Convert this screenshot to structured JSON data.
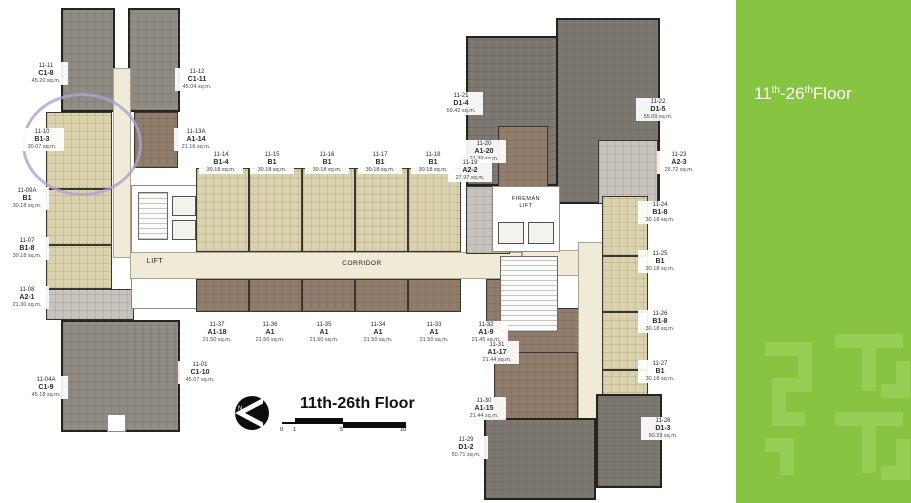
{
  "floorplan": {
    "title": "11th-26th Floor",
    "corridor_label": "CORRIDOR",
    "lift_label": "LIFT",
    "fireman_lift_line1": "FIREMAN",
    "fireman_lift_line2": "LIFT",
    "north_label": "N",
    "scale_ticks": [
      "0",
      "1",
      "5",
      "10"
    ],
    "units": [
      {
        "no": "11-11",
        "type": "C1-8",
        "area": "45.20 sq.m.",
        "lx": 24,
        "ly": 62
      },
      {
        "no": "11-12",
        "type": "C1-11",
        "area": "45.04 sq.m.",
        "lx": 175,
        "ly": 68
      },
      {
        "no": "11-10",
        "type": "B1-3",
        "area": "30.07 sq.m.",
        "lx": 20,
        "ly": 128
      },
      {
        "no": "11-13A",
        "type": "A1-14",
        "area": "21.16 sq.m.",
        "lx": 174,
        "ly": 128
      },
      {
        "no": "11-09A",
        "type": "B1",
        "area": "30.18 sq.m.",
        "lx": 5,
        "ly": 187
      },
      {
        "no": "11-07",
        "type": "B1-8",
        "area": "30.18 sq.m.",
        "lx": 5,
        "ly": 237
      },
      {
        "no": "11-08",
        "type": "A2-1",
        "area": "21.30 sq.m.",
        "lx": 5,
        "ly": 286
      },
      {
        "no": "11-04A",
        "type": "C1-9",
        "area": "45.18 sq.m.",
        "lx": 24,
        "ly": 376
      },
      {
        "no": "11-01",
        "type": "C1-10",
        "area": "45.07 sq.m.",
        "lx": 178,
        "ly": 361
      },
      {
        "no": "11-14",
        "type": "B1-4",
        "area": "30.18 sq.m.",
        "lx": 199,
        "ly": 151
      },
      {
        "no": "11-15",
        "type": "B1",
        "area": "30.18 sq.m.",
        "lx": 250,
        "ly": 151
      },
      {
        "no": "11-16",
        "type": "B1",
        "area": "30.18 sq.m.",
        "lx": 305,
        "ly": 151
      },
      {
        "no": "11-17",
        "type": "B1",
        "area": "30.18 sq.m.",
        "lx": 358,
        "ly": 151
      },
      {
        "no": "11-18",
        "type": "B1",
        "area": "30.18 sq.m.",
        "lx": 411,
        "ly": 151
      },
      {
        "no": "11-37",
        "type": "A1-18",
        "area": "21.50 sq.m.",
        "lx": 195,
        "ly": 321
      },
      {
        "no": "11-36",
        "type": "A1",
        "area": "21.50 sq.m.",
        "lx": 248,
        "ly": 321
      },
      {
        "no": "11-35",
        "type": "A1",
        "area": "21.50 sq.m.",
        "lx": 302,
        "ly": 321
      },
      {
        "no": "11-34",
        "type": "A1",
        "area": "21.50 sq.m.",
        "lx": 356,
        "ly": 321
      },
      {
        "no": "11-33",
        "type": "A1",
        "area": "21.50 sq.m.",
        "lx": 412,
        "ly": 321
      },
      {
        "no": "11-32",
        "type": "A1-9",
        "area": "21.45 sq.m.",
        "lx": 464,
        "ly": 321
      },
      {
        "no": "11-31",
        "type": "A1-17",
        "area": "21.44 sq.m.",
        "lx": 475,
        "ly": 341
      },
      {
        "no": "11-30",
        "type": "A1-15",
        "area": "21.44 sq.m.",
        "lx": 462,
        "ly": 397
      },
      {
        "no": "11-21",
        "type": "D1-4",
        "area": "59.42 sq.m.",
        "lx": 439,
        "ly": 92
      },
      {
        "no": "11-22",
        "type": "D1-5",
        "area": "55.09 sq.m.",
        "lx": 636,
        "ly": 98
      },
      {
        "no": "11-20",
        "type": "A1-20",
        "area": "21.39 sq.m.",
        "lx": 462,
        "ly": 140
      },
      {
        "no": "11-19",
        "type": "A2-2",
        "area": "27.97 sq.m.",
        "lx": 448,
        "ly": 159
      },
      {
        "no": "11-23",
        "type": "A2-3",
        "area": "26.72 sq.m.",
        "lx": 657,
        "ly": 151
      },
      {
        "no": "11-24",
        "type": "B1-8",
        "area": "30.18 sq.m.",
        "lx": 638,
        "ly": 201
      },
      {
        "no": "11-25",
        "type": "B1",
        "area": "30.18 sq.m.",
        "lx": 638,
        "ly": 250
      },
      {
        "no": "11-26",
        "type": "B1-8",
        "area": "30.18 sq.m.",
        "lx": 638,
        "ly": 310
      },
      {
        "no": "11-27",
        "type": "B1",
        "area": "30.18 sq.m.",
        "lx": 638,
        "ly": 360
      },
      {
        "no": "11-29",
        "type": "D1-2",
        "area": "50.71 sq.m.",
        "lx": 444,
        "ly": 436
      },
      {
        "no": "11-28",
        "type": "D1-3",
        "area": "50.29 sq.m.",
        "lx": 641,
        "ly": 417
      }
    ],
    "blocks": [
      {
        "name": "tower-c1-8",
        "x": 61,
        "y": 8,
        "w": 54,
        "h": 104,
        "cat": "gray"
      },
      {
        "name": "tower-c1-11",
        "x": 128,
        "y": 8,
        "w": 52,
        "h": 104,
        "cat": "gray"
      },
      {
        "name": "unit-block-b1-3",
        "x": 46,
        "y": 112,
        "w": 66,
        "h": 77,
        "cat": "beige"
      },
      {
        "name": "unit-block-a1-14",
        "x": 134,
        "y": 112,
        "w": 44,
        "h": 56,
        "cat": "brown"
      },
      {
        "name": "unit-block-b1-09a",
        "x": 46,
        "y": 189,
        "w": 66,
        "h": 56,
        "cat": "beige"
      },
      {
        "name": "unit-block-b1-8-07",
        "x": 46,
        "y": 245,
        "w": 66,
        "h": 44,
        "cat": "beige"
      },
      {
        "name": "unit-block-a2-1",
        "x": 46,
        "y": 289,
        "w": 88,
        "h": 31,
        "cat": "a2"
      },
      {
        "name": "tower-c1-9-c1-10",
        "x": 61,
        "y": 320,
        "w": 119,
        "h": 112,
        "cat": "gray"
      },
      {
        "name": "notch-bottom-left",
        "x": 107,
        "y": 414,
        "w": 19,
        "h": 18,
        "cat": "white"
      },
      {
        "name": "corridor-vertical-left",
        "x": 113,
        "y": 68,
        "w": 18,
        "h": 190,
        "cat": "cream"
      },
      {
        "name": "core-left",
        "x": 131,
        "y": 185,
        "w": 71,
        "h": 124,
        "cat": "white"
      },
      {
        "name": "stair-left",
        "x": 138,
        "y": 192,
        "w": 30,
        "h": 48,
        "cat": "stair"
      },
      {
        "name": "lift-shaft-left-1",
        "x": 172,
        "y": 196,
        "w": 24,
        "h": 20,
        "cat": "shaft"
      },
      {
        "name": "lift-shaft-left-2",
        "x": 172,
        "y": 220,
        "w": 24,
        "h": 20,
        "cat": "shaft"
      },
      {
        "name": "unit-block-b1-4",
        "x": 196,
        "y": 168,
        "w": 53,
        "h": 84,
        "cat": "beige"
      },
      {
        "name": "unit-block-b1-15",
        "x": 249,
        "y": 168,
        "w": 53,
        "h": 84,
        "cat": "beige"
      },
      {
        "name": "unit-block-b1-16",
        "x": 302,
        "y": 168,
        "w": 53,
        "h": 84,
        "cat": "beige"
      },
      {
        "name": "unit-block-b1-17",
        "x": 355,
        "y": 168,
        "w": 53,
        "h": 84,
        "cat": "beige"
      },
      {
        "name": "unit-block-b1-18",
        "x": 408,
        "y": 168,
        "w": 53,
        "h": 84,
        "cat": "beige"
      },
      {
        "name": "corridor-main",
        "x": 130,
        "y": 252,
        "w": 392,
        "h": 27,
        "cat": "cream"
      },
      {
        "name": "unit-block-a1-18-37",
        "x": 196,
        "y": 279,
        "w": 53,
        "h": 33,
        "cat": "brown"
      },
      {
        "name": "unit-block-a1-36",
        "x": 249,
        "y": 279,
        "w": 53,
        "h": 33,
        "cat": "brown"
      },
      {
        "name": "unit-block-a1-35",
        "x": 302,
        "y": 279,
        "w": 53,
        "h": 33,
        "cat": "brown"
      },
      {
        "name": "unit-block-a1-34",
        "x": 355,
        "y": 279,
        "w": 53,
        "h": 33,
        "cat": "brown"
      },
      {
        "name": "unit-block-a1-33",
        "x": 408,
        "y": 279,
        "w": 53,
        "h": 33,
        "cat": "brown"
      },
      {
        "name": "unit-block-a1-9",
        "x": 486,
        "y": 279,
        "w": 72,
        "h": 50,
        "cat": "brown"
      },
      {
        "name": "unit-block-a1-17",
        "x": 506,
        "y": 308,
        "w": 80,
        "h": 62,
        "cat": "brown"
      },
      {
        "name": "unit-block-a1-15",
        "x": 494,
        "y": 352,
        "w": 84,
        "h": 78,
        "cat": "brown"
      },
      {
        "name": "tower-d1-4",
        "x": 466,
        "y": 36,
        "w": 102,
        "h": 150,
        "cat": "dgray"
      },
      {
        "name": "tower-d1-5",
        "x": 556,
        "y": 18,
        "w": 104,
        "h": 186,
        "cat": "dgray"
      },
      {
        "name": "unit-block-a1-20",
        "x": 498,
        "y": 126,
        "w": 50,
        "h": 80,
        "cat": "brown"
      },
      {
        "name": "unit-block-a2-2",
        "x": 466,
        "y": 186,
        "w": 44,
        "h": 68,
        "cat": "a2"
      },
      {
        "name": "unit-block-a2-3",
        "x": 598,
        "y": 140,
        "w": 60,
        "h": 64,
        "cat": "a2"
      },
      {
        "name": "corridor-right-h",
        "x": 522,
        "y": 250,
        "w": 86,
        "h": 26,
        "cat": "cream"
      },
      {
        "name": "corridor-right-v",
        "x": 578,
        "y": 242,
        "w": 28,
        "h": 196,
        "cat": "cream"
      },
      {
        "name": "core-fireman",
        "x": 492,
        "y": 186,
        "w": 68,
        "h": 66,
        "cat": "white"
      },
      {
        "name": "lift-shaft-fireman-1",
        "x": 498,
        "y": 222,
        "w": 26,
        "h": 22,
        "cat": "shaft"
      },
      {
        "name": "lift-shaft-fireman-2",
        "x": 528,
        "y": 222,
        "w": 26,
        "h": 22,
        "cat": "shaft"
      },
      {
        "name": "stair-right",
        "x": 500,
        "y": 256,
        "w": 58,
        "h": 76,
        "cat": "stair"
      },
      {
        "name": "unit-block-b1-8-24",
        "x": 602,
        "y": 196,
        "w": 46,
        "h": 60,
        "cat": "beige"
      },
      {
        "name": "unit-block-b1-25",
        "x": 602,
        "y": 256,
        "w": 46,
        "h": 56,
        "cat": "beige"
      },
      {
        "name": "unit-block-b1-8-26",
        "x": 602,
        "y": 312,
        "w": 46,
        "h": 58,
        "cat": "beige"
      },
      {
        "name": "unit-block-b1-27",
        "x": 602,
        "y": 370,
        "w": 46,
        "h": 64,
        "cat": "beige"
      },
      {
        "name": "tower-d1-2",
        "x": 484,
        "y": 418,
        "w": 112,
        "h": 82,
        "cat": "dgray"
      },
      {
        "name": "tower-d1-3",
        "x": 596,
        "y": 394,
        "w": 66,
        "h": 94,
        "cat": "dgray"
      }
    ]
  },
  "sidebar": {
    "floor_text": [
      "11",
      "th",
      "-26",
      "th",
      "Floor"
    ]
  },
  "highlight": {
    "circled_unit": "11-10 B1-3",
    "ring_color": "#ABA3D4"
  },
  "colors": {
    "gray": "#908C84",
    "dgray": "#7C7871",
    "beige": "#D9D2AC",
    "brown": "#907C6A",
    "a2": "#C8C4BD",
    "cream": "#F0EBD7",
    "white": "#FFFFFF",
    "stair": "#FBFBF9",
    "shaft": "#F4F2EC",
    "panel_bg": "#86C441",
    "panel_pattern": "#95CD55",
    "panel_text": "#FFFFFF"
  }
}
